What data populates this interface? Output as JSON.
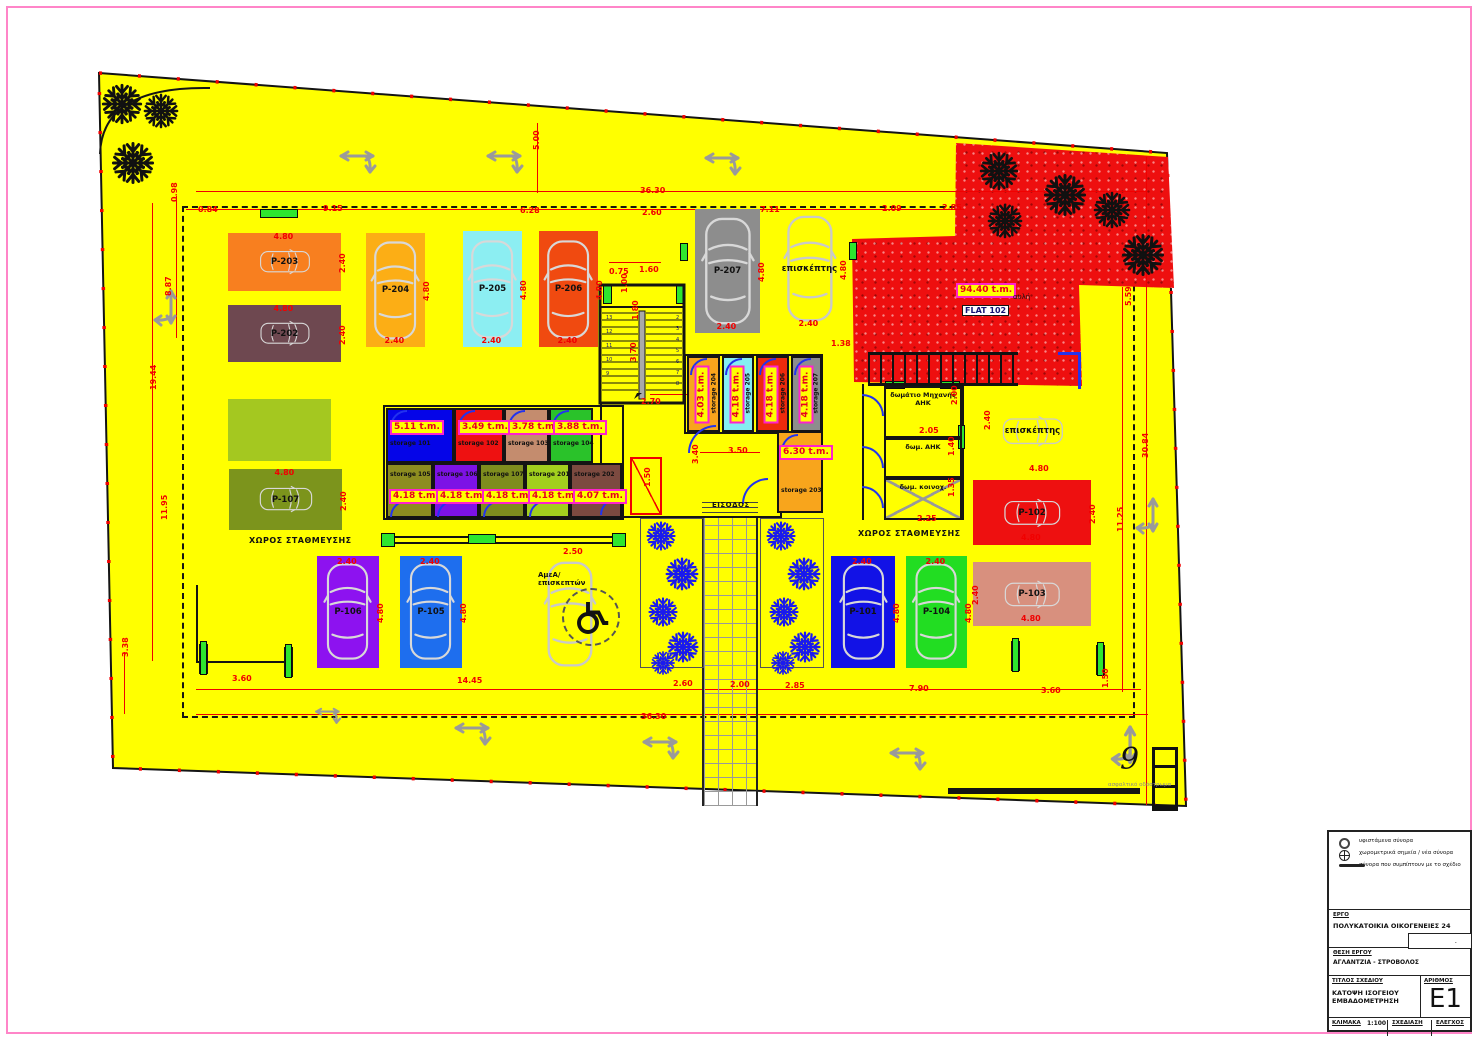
{
  "drawing": {
    "plot_color": "#ffff00",
    "dimension_color": "#f10000",
    "labels": {
      "parking_area_left": "ΧΩΡΟΣ ΣΤΑΘΜΕΥΣΗΣ",
      "parking_area_right": "ΧΩΡΟΣ ΣΤΑΘΜΕΥΣΗΣ",
      "entrance": "ΕΙΣΟΔΟΣ",
      "plot_number": "9",
      "road_note": "ασφαλτικό οδόστρωμα"
    },
    "red_zone": {
      "area": "94.40 t.m.",
      "flat": "FLAT 102",
      "court": "αυλή",
      "color": "#ee0f0f"
    },
    "parking_stalls": [
      {
        "label": "P-203",
        "color": "#f87f1f",
        "main": "4.80",
        "cross": "2.40"
      },
      {
        "label": "P-202",
        "color": "#6e4850",
        "main": "4.80",
        "cross": "2.40"
      },
      {
        "label": "P-204",
        "color": "#fcae15",
        "main": "4.80",
        "cross": "2.40"
      },
      {
        "label": "P-205",
        "color": "#8ceef2",
        "main": "4.80",
        "cross": "2.40"
      },
      {
        "label": "P-206",
        "color": "#f04a10",
        "main": "4.80",
        "cross": "2.40"
      },
      {
        "label": "P-207",
        "color": "#8d8d8d",
        "main": "4.80",
        "cross": "2.40"
      },
      {
        "label": "επισκέπτης",
        "color": "",
        "main": "4.80",
        "cross": "2.40"
      },
      {
        "label": "P-107",
        "color": "#7c941c",
        "main": "4.80",
        "cross": "2.40"
      },
      {
        "label": "P-106",
        "color": "#8d12f0",
        "main": "4.80",
        "cross": "2.40"
      },
      {
        "label": "P-105",
        "color": "#1e6eee",
        "main": "4.80",
        "cross": "2.40"
      },
      {
        "label": "ΑμεΑ/\nεπισκεπτών",
        "color": "",
        "main": "",
        "cross": ""
      },
      {
        "label": "P-101",
        "color": "#1212e6",
        "main": "4.80",
        "cross": "2.40"
      },
      {
        "label": "P-104",
        "color": "#22dd22",
        "main": "4.80",
        "cross": "2.40"
      },
      {
        "label": "P-103",
        "color": "#d8907e",
        "main": "4.80",
        "cross": "2.40"
      },
      {
        "label": "P-102",
        "color": "#ee1010",
        "main": "4.80",
        "cross": "2.40"
      },
      {
        "label": "επισκέπτης",
        "color": "",
        "main": "",
        "cross": ""
      }
    ],
    "storages": [
      {
        "label": "storage 101",
        "area": "5.11 t.m.",
        "color": "#0505e8"
      },
      {
        "label": "storage 102",
        "area": "3.49 t.m.",
        "color": "#ee1111"
      },
      {
        "label": "storage 103",
        "area": "3.78 t.m.",
        "color": "#c48c6e"
      },
      {
        "label": "storage 104",
        "area": "3.88 t.m.",
        "color": "#2ac22a"
      },
      {
        "label": "storage 105",
        "area": "4.18 t.m.",
        "color": "#8d8d20"
      },
      {
        "label": "storage 106",
        "area": "4.18 t.m.",
        "color": "#7d12e6"
      },
      {
        "label": "storage 107",
        "area": "4.18 t.m.",
        "color": "#7e8d1e"
      },
      {
        "label": "storage 201",
        "area": "4.18 t.m.",
        "color": "#a2cf1e"
      },
      {
        "label": "storage 202",
        "area": "4.07 t.m.",
        "color": "#7c4a40"
      },
      {
        "label": "storage 204",
        "area": "4.03 t.m.",
        "color": "#f8a51c"
      },
      {
        "label": "storage 205",
        "area": "4.18 t.m.",
        "color": "#84eef2"
      },
      {
        "label": "storage 206",
        "area": "4.18 t.m.",
        "color": "#ee2a0c"
      },
      {
        "label": "storage 207",
        "area": "4.18 t.m.",
        "color": "#8d8d8d"
      },
      {
        "label": "storage 203",
        "area": "6.30 t.m.",
        "color": "#f8a51c"
      }
    ],
    "rooms": [
      {
        "label": "δωμάτιο Μηχανής\nΑΗΚ"
      },
      {
        "label": "δωμ. ΑΗΚ"
      },
      {
        "label": "δωμ. κοινοχ."
      }
    ],
    "dimensions": [
      "36.30",
      "0.84",
      "9.15",
      "6.28",
      "2.60",
      "7.11",
      "2.09",
      "2.85",
      "5.00",
      "0.98",
      "8.87",
      "19.44",
      "11.95",
      "3.38",
      "5.59",
      "30.84",
      "11.25",
      "1.50",
      "3.60",
      "14.45",
      "2.60",
      "2.00",
      "2.85",
      "7.90",
      "3.60",
      "36.30",
      "0.75",
      "1.60",
      "1.00",
      "1.80",
      "3.70",
      "2.70",
      "3.50",
      "3.40",
      "1.50",
      "1.38",
      "2.05",
      "2.00",
      "1.40",
      "1.35",
      "2.25",
      "2.40",
      "4.80",
      "2.50"
    ],
    "stairs": {
      "treads_left": [
        "13",
        "12",
        "11",
        "10",
        "9"
      ],
      "treads_right": [
        "2",
        "3",
        "4",
        "5",
        "6",
        "7",
        "8"
      ]
    }
  },
  "title_block": {
    "legend": [
      "υφιστάμενα σύνορα",
      "χωρομετρικά σημεία / νέα σύνορα",
      "σύνορα που συμπίπτουν με το σχέδιο"
    ],
    "project_label": "ΕΡΓΟ",
    "project": "ΠΟΛΥΚΑΤΟΙΚΙΑ ΟΙΚΟΓΕΝΕΙΕΣ 24",
    "location_label": "ΘΕΣΗ ΕΡΓΟΥ",
    "location": "ΑΓΛΑΝΤΖΙΑ - ΣΤΡΟΒΟΛΟΣ",
    "title_label": "ΤΙΤΛΟΣ ΣΧΕΔΙΟΥ",
    "title1": "ΚΑΤΟΨΗ ΙΣΟΓΕΙΟΥ",
    "title2": "ΕΜΒΑΔΟΜΕΤΡΗΣΗ",
    "number_label": "ΑΡΙΘΜΟΣ",
    "number": "E1",
    "scale_label": "ΚΛΙΜΑΚΑ",
    "scale": "1:100",
    "drawn_label": "ΣΧΕΔΙΑΣΗ",
    "check_label": "ΕΛΕΓΧΟΣ"
  }
}
